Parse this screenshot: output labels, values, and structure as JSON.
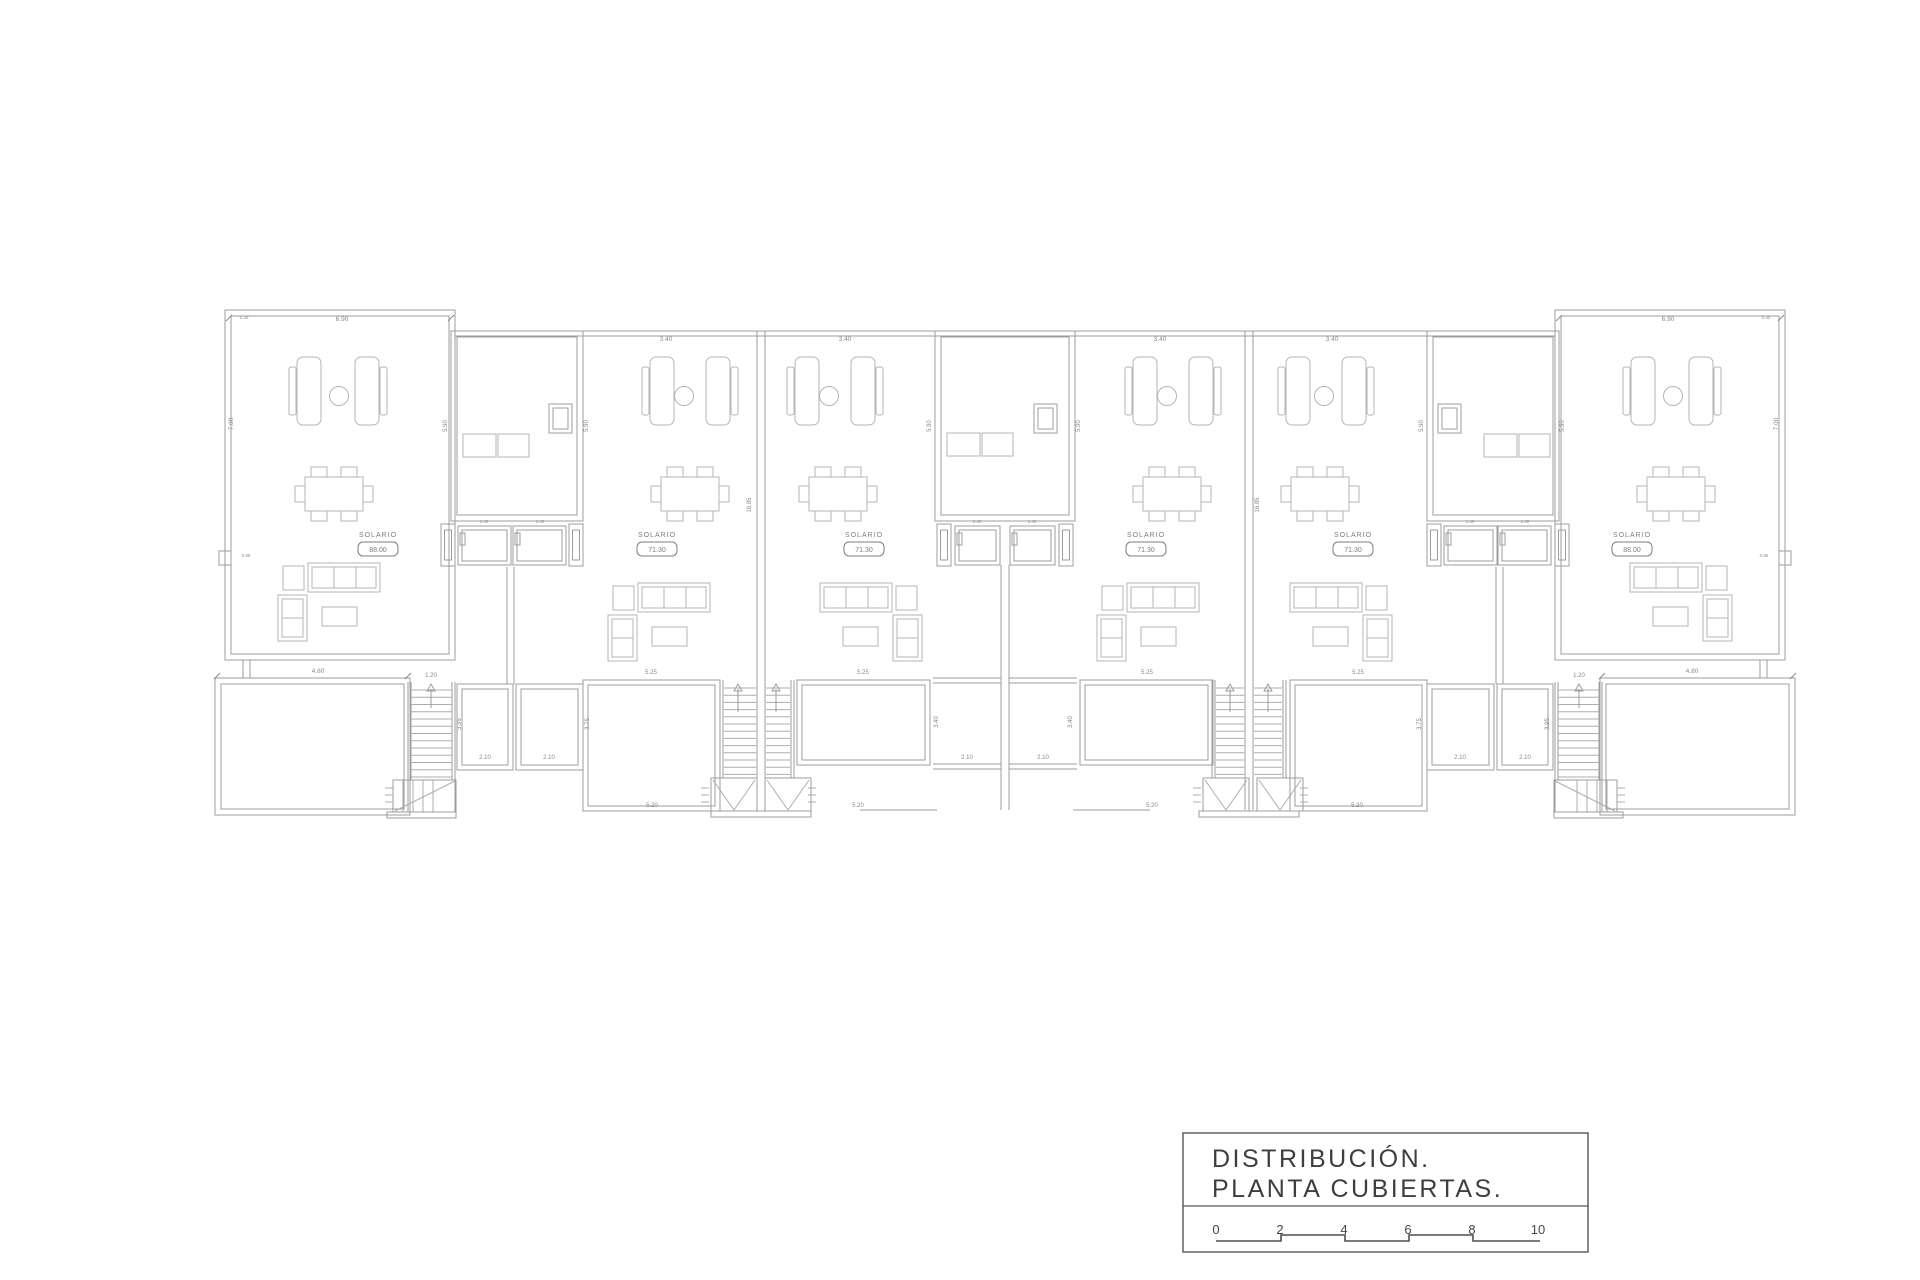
{
  "title_block": {
    "line1": "DISTRIBUCIÓN.",
    "line2": "PLANTA  CUBIERTAS.",
    "scale_ticks": [
      "0",
      "2",
      "4",
      "6",
      "8",
      "10"
    ]
  },
  "plan": {
    "solario_label": "SOLARIO",
    "areas": [
      "88.00",
      "71.30",
      "71.30",
      "71.30",
      "71.30",
      "88.00"
    ],
    "dims": {
      "top": [
        "6.90",
        "3.40",
        "3.40",
        "3.40",
        "3.40",
        "6.90"
      ],
      "width_480": "4.80",
      "width_120": "1.20",
      "width_525": "5.25",
      "width_520": "5.20",
      "width_210": "2.10",
      "height_700": "7.00",
      "height_590": "5.90",
      "height_1685": "16.85",
      "height_395": "3.95",
      "height_375": "3.75",
      "height_340": "3.40",
      "step_095": "0.95",
      "step_030": "0.30",
      "hatch_140": "1.40"
    }
  },
  "colors": {
    "line": "#adadad",
    "wall": "#9c9c9c",
    "furniture": "#b5b5b5",
    "dim_text": "#8a8a8a",
    "label_text": "#7d7d7d",
    "title_text": "#3e3e3e",
    "block_border": "#555555",
    "background": "#ffffff"
  }
}
